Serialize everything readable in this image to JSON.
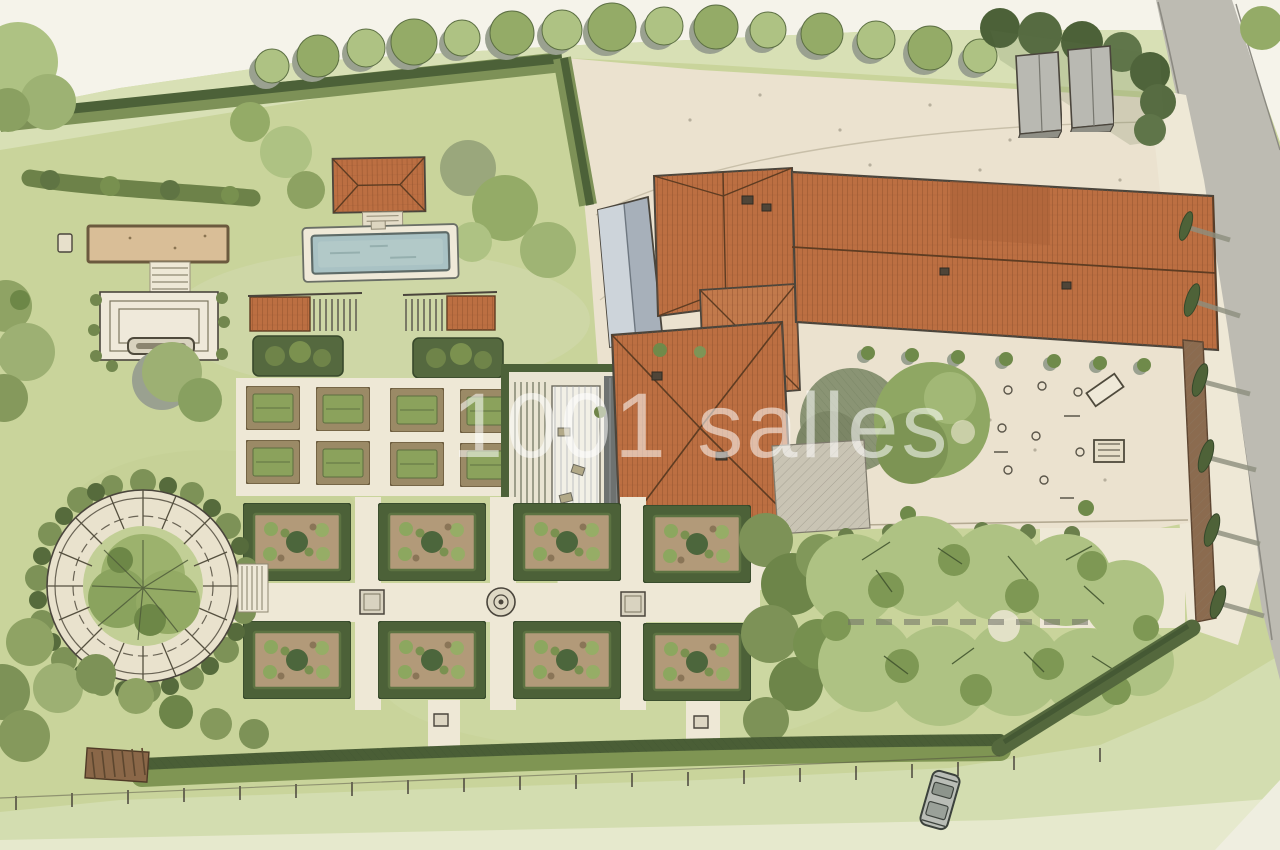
{
  "meta": {
    "kind": "watercolor-garden-site-plan",
    "view": "aerial-plan-illustration"
  },
  "watermark": {
    "text": "1001 salles",
    "color": "rgba(255,255,255,0.55)"
  },
  "palette": {
    "paper": "#f5f3ea",
    "field": "#d8e0b5",
    "fieldLow": "#d3ddb0",
    "lawn": "#c9d49b",
    "gravel": "#ebe2cf",
    "gravelLight": "#eee8d6",
    "sand": "#d9be97",
    "soil": "#b29a79",
    "hedge": "#72874e",
    "hedgeDark": "#4c6138",
    "tree": "#94ab67",
    "treeLight": "#aec283",
    "treeShadow": "#9aa190",
    "bosquet": "#7d9257",
    "roof": "#bc6f42",
    "roofDark": "#8e4f2b",
    "roofGray": "#a7b0ba",
    "water": "#a9c2c4",
    "road": "#bdbbb2",
    "wall": "#8b6b4f",
    "paving": "#c9c4b4",
    "ink": "#4a453c"
  },
  "features": [
    {
      "name": "boundary-hedge-north"
    },
    {
      "name": "tree-row-north"
    },
    {
      "name": "access-road-east"
    },
    {
      "name": "garden-sheds"
    },
    {
      "name": "sand-court"
    },
    {
      "name": "fountain-plaza"
    },
    {
      "name": "pool-house"
    },
    {
      "name": "swimming-pool"
    },
    {
      "name": "pergolas"
    },
    {
      "name": "potager-beds"
    },
    {
      "name": "walled-greenhouse-garden"
    },
    {
      "name": "main-house"
    },
    {
      "name": "long-barn"
    },
    {
      "name": "entry-courtyard"
    },
    {
      "name": "courtyard-terrace"
    },
    {
      "name": "parterre-garden"
    },
    {
      "name": "circular-pergola-garden"
    },
    {
      "name": "orchard-grove"
    },
    {
      "name": "east-wall-cypresses"
    },
    {
      "name": "south-hedge-and-fence"
    },
    {
      "name": "parked-car"
    }
  ]
}
